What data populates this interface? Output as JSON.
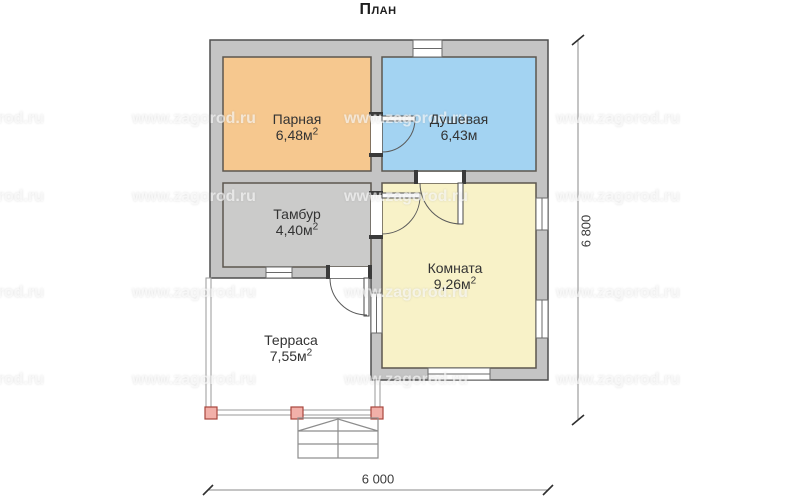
{
  "title": "План",
  "watermark": {
    "text": "www.zagorod.ru"
  },
  "plan": {
    "rooms": [
      {
        "name": "Парная",
        "area": "6,48м",
        "area_sup": "2",
        "color": "#f6c88f"
      },
      {
        "name": "Душевая",
        "area": "6,43м",
        "area_sup": "",
        "color": "#a3d3f2"
      },
      {
        "name": "Тамбур",
        "area": "4,40м",
        "area_sup": "2",
        "color": "#cbcbca"
      },
      {
        "name": "Комната",
        "area": "9,26м",
        "area_sup": "2",
        "color": "#f8f2c8"
      },
      {
        "name": "Терраса",
        "area": "7,55м",
        "area_sup": "2",
        "color": "#ffffff"
      }
    ],
    "dimensions": {
      "width": "6 000",
      "height": "6 800"
    },
    "colors": {
      "wall_fill": "#c4c4c4",
      "wall_stroke": "#4f4f4f",
      "post_fill": "#f2b0a9",
      "post_stroke": "#a8453c"
    }
  }
}
